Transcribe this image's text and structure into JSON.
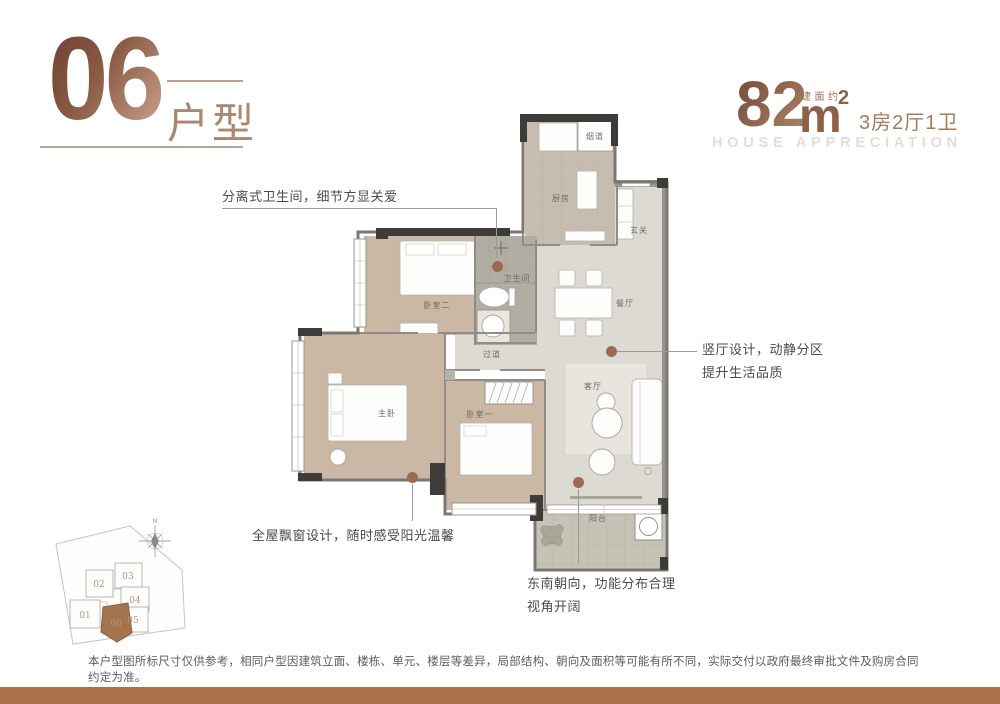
{
  "header": {
    "unit_number": "06",
    "unit_type_label": "户型",
    "area_prefix": "建面约",
    "area_value": "82",
    "area_unit": "m",
    "area_exponent": "2",
    "room_summary": "3房2厅1卫",
    "tagline_en": "HOUSE APPRECIATION"
  },
  "floorplan": {
    "rooms": {
      "kitchen": "厨房",
      "flue": "烟道",
      "entry": "玄关",
      "dining": "餐厅",
      "bathroom": "卫生间",
      "bedroom2": "卧室二",
      "corridor": "过道",
      "master_bedroom": "主卧",
      "bedroom1": "卧室一",
      "living": "客厅",
      "balcony": "阳台"
    }
  },
  "annotations": {
    "separate_bathroom": "分离式卫生间，细节方显关爱",
    "vertical_hall_line1": "竖厅设计，动静分区",
    "vertical_hall_line2": "提升生活品质",
    "bay_windows": "全屋飘窗设计，随时感受阳光温馨",
    "orientation_line1": "东南朝向，功能分布合理",
    "orientation_line2": "视角开阔"
  },
  "siteplan": {
    "north_label": "N",
    "buildings": [
      {
        "id": "01",
        "highlighted": false
      },
      {
        "id": "02",
        "highlighted": false
      },
      {
        "id": "03",
        "highlighted": false
      },
      {
        "id": "04",
        "highlighted": false
      },
      {
        "id": "05",
        "highlighted": false
      },
      {
        "id": "06",
        "highlighted": true
      }
    ]
  },
  "footer": {
    "disclaimer": "本户型图所标尺寸仅供参考，相同户型因建筑立面、楼栋、单元、楼层等差异，局部结构、朝向及面积等可能有所不同，实际交付以政府最终审批文件及购房合同约定为准。"
  },
  "colors": {
    "bronze_dark": "#6e4331",
    "bronze_light": "#c9a08b",
    "accent_brown": "#a5744e",
    "bottom_bar": "#a8714b",
    "annotation_dot": "#9c6a52"
  }
}
